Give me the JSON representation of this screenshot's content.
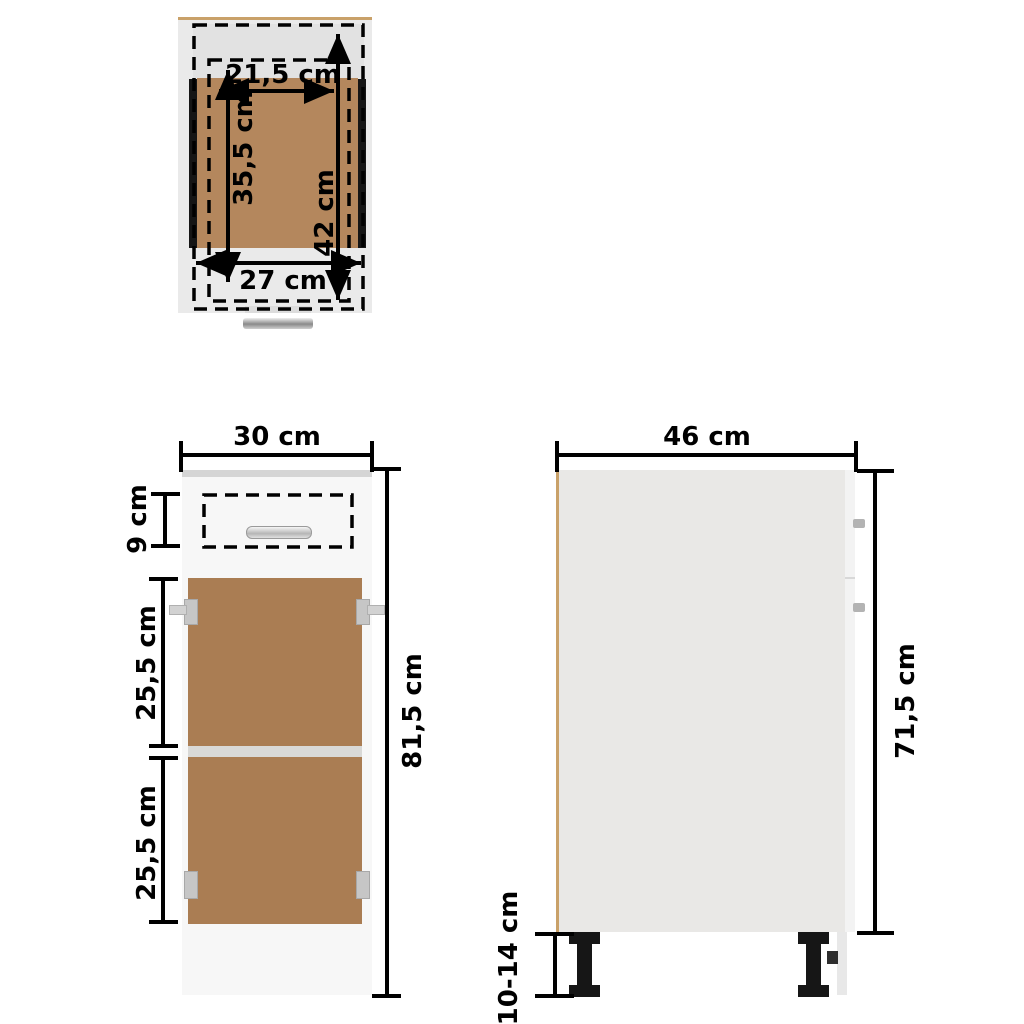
{
  "diagram": {
    "title": "Kitchen base cabinet with drawer - dimension diagram",
    "units": "cm",
    "colors": {
      "wood_interior": "#aa7d53",
      "wood_drawer_bottom": "#b4875d",
      "wood_edge_tan": "#c9a169",
      "panel_gray": "#eaeaea",
      "dimension_black": "#000000",
      "background": "#ffffff"
    }
  },
  "top_view": {
    "name": "drawer top view",
    "labels": {
      "inner_width": "21,5 cm",
      "inner_depth": "35,5 cm",
      "outer_depth": "42 cm",
      "outer_width": "27 cm"
    }
  },
  "front_view": {
    "name": "cabinet front view",
    "labels": {
      "width": "30 cm",
      "drawer_height": "9 cm",
      "upper_section_height": "25,5 cm",
      "lower_section_height": "25,5 cm",
      "total_height": "81,5 cm"
    }
  },
  "side_view": {
    "name": "cabinet side view",
    "labels": {
      "depth": "46 cm",
      "body_height": "71,5 cm",
      "leg_height": "10-14 cm"
    }
  }
}
